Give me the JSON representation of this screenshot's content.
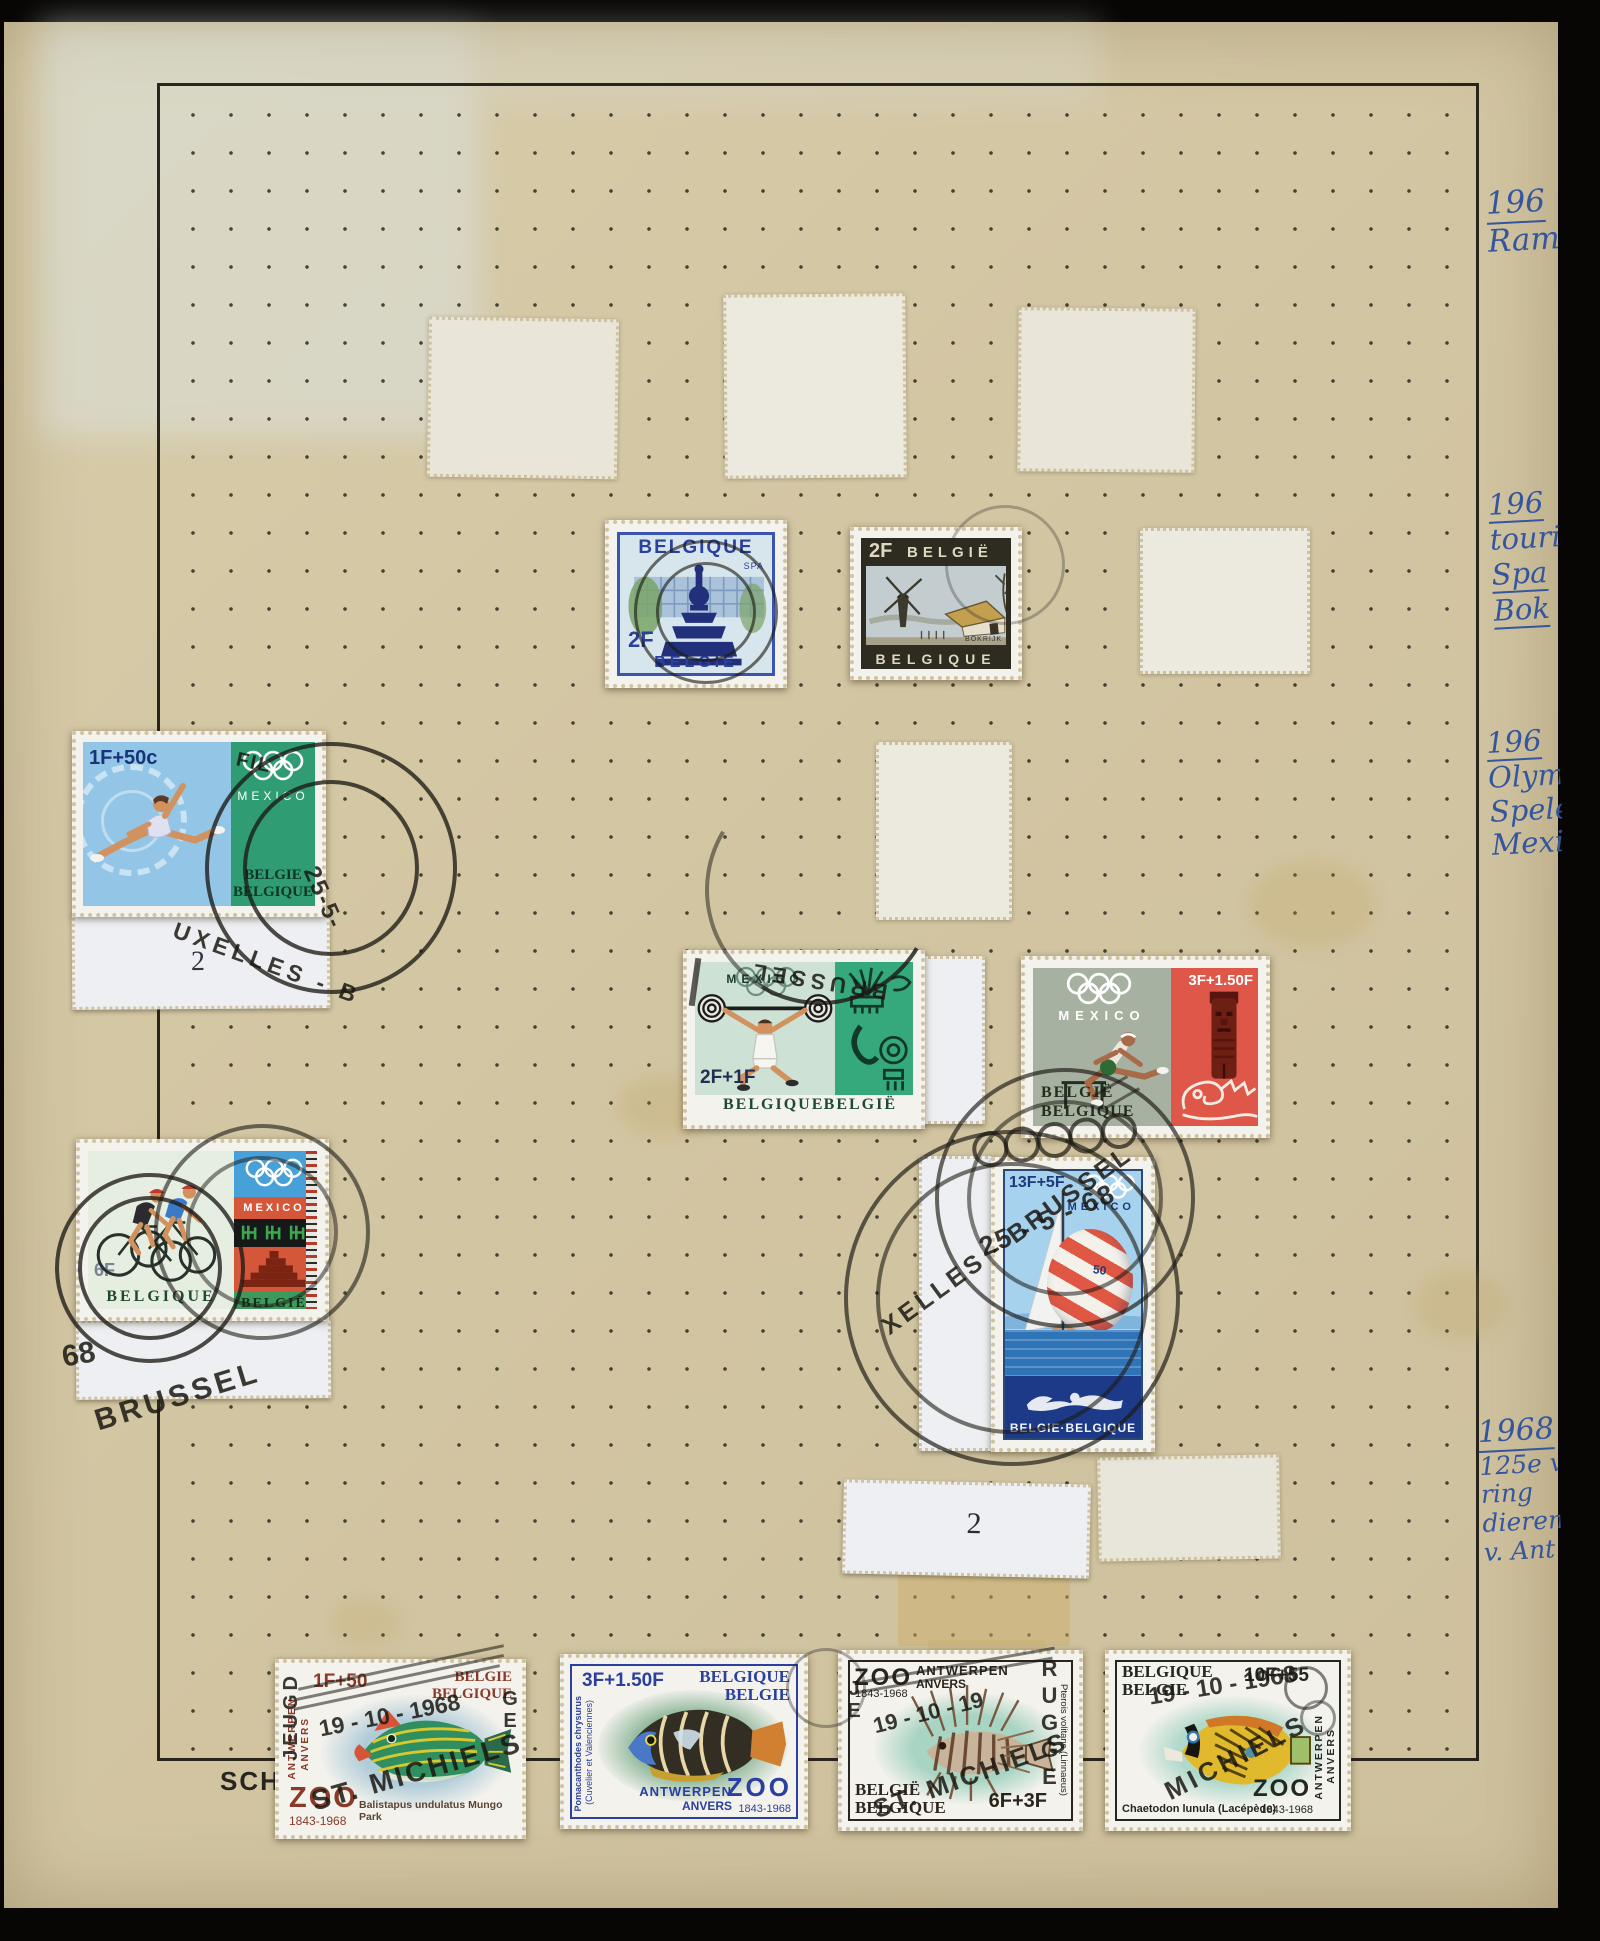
{
  "album": {
    "brand": "SCHAU-",
    "plate2a": "2",
    "plate2b": "2",
    "notes": {
      "n1": {
        "y1": "196",
        "t1": "Ram"
      },
      "n2": {
        "y1": "196",
        "t1": "touri",
        "t2": "Spa",
        "t3": "Bok"
      },
      "n3": {
        "y1": "196",
        "t1": "Olymp",
        "t2": "Spele",
        "t3": "Mexi"
      },
      "n4": {
        "y1": "1968",
        "t1": "125e ve",
        "t2": "ring",
        "t3": "dieren",
        "t4": "v. Ant"
      }
    }
  },
  "stamps": {
    "spa": {
      "top": "BELGIQUE",
      "place": "SPA",
      "value": "2F",
      "bottom": "BELGIE"
    },
    "bokrijk": {
      "value": "2F",
      "top": "BELGIË",
      "bottom": "BELGIQUE",
      "place": "BOKRIJK"
    },
    "gymnast": {
      "value": "1F+50c",
      "mexico": "MEXICO",
      "c1": "BELGIE",
      "c2": "BELGIQUE"
    },
    "weightlifter": {
      "mexico": "MEXICO",
      "value": "2F+1F",
      "c1": "BELGIQUE",
      "c2": "BELGIË"
    },
    "hurdler": {
      "value": "3F+1.50F",
      "mexico": "MEXICO",
      "c1": "BELGIË",
      "c2": "BELGIQUE"
    },
    "cyclists": {
      "mexico": "MEXICO",
      "value": "6F",
      "c1": "BELGIQUE",
      "c2": "BELGIË"
    },
    "sailing": {
      "value": "13F+5F",
      "mexico": "MEXICO",
      "sail": "50",
      "country": "BELGIE·BELGIQUE"
    },
    "fish1": {
      "value": "1F+50",
      "c1": "BELGIE",
      "c2": "BELGIQUE",
      "city1": "ANTWERPEN",
      "city2": "ANVERS",
      "zoo": "ZOO",
      "years": "1843-1968",
      "species": "Balistapus undulatus Mungo Park"
    },
    "fish2": {
      "value": "3F+1.50F",
      "c1": "BELGIQUE",
      "c2": "BELGIE",
      "sp1": "Pomacanthodes chrysurus",
      "sp2": "(Cuvelier et Valenciennes)",
      "city1": "ANTWERPEN",
      "city2": "ANVERS",
      "zoo": "ZOO",
      "years": "1843-1968"
    },
    "fish3": {
      "zoo": "ZOO",
      "city1": "ANTWERPEN",
      "city2": "ANVERS",
      "years": "1843-1968",
      "c1": "BELGIË",
      "c2": "BELGIQUE",
      "value": "6F+3F",
      "species": "Pterois volitans (Linnaeus)"
    },
    "fish4": {
      "c1": "BELGIQUE",
      "c2": "BELGIE",
      "value": "10F+55",
      "species": "Chaetodon lunula (Lacépède)",
      "city1": "ANTWERPEN",
      "city2": "ANVERS",
      "zoo": "ZOO",
      "years": "1843-1968"
    }
  },
  "postmarks": {
    "gym_date": "25-5-",
    "gym_arc": "UXELLES - B",
    "gym_fil": "FIL",
    "cyc_year": "68",
    "cyc_city": "BRUSSEL",
    "sail_date": "25 - 5 - 68",
    "sail_arc": "XELLES - BRUSSEL",
    "wl_city": "BRUSSEL",
    "f1_date": "19 - 10 - 1968",
    "f1_city": "ST. MICHIELS",
    "f1_left": "JEUGD",
    "f1_right": "GE",
    "f3_date": "19 - 10 - 19",
    "f3_city": "ST. MICHIELS",
    "f3_right": "RUGGE",
    "f3_left": "JE",
    "f4_date": "19 - 10 - 1968",
    "f4_city": "MICHIELS"
  },
  "colors": {
    "page": "#d3c6a3",
    "ink": "#34569e",
    "cancel": "#1c1a14"
  }
}
